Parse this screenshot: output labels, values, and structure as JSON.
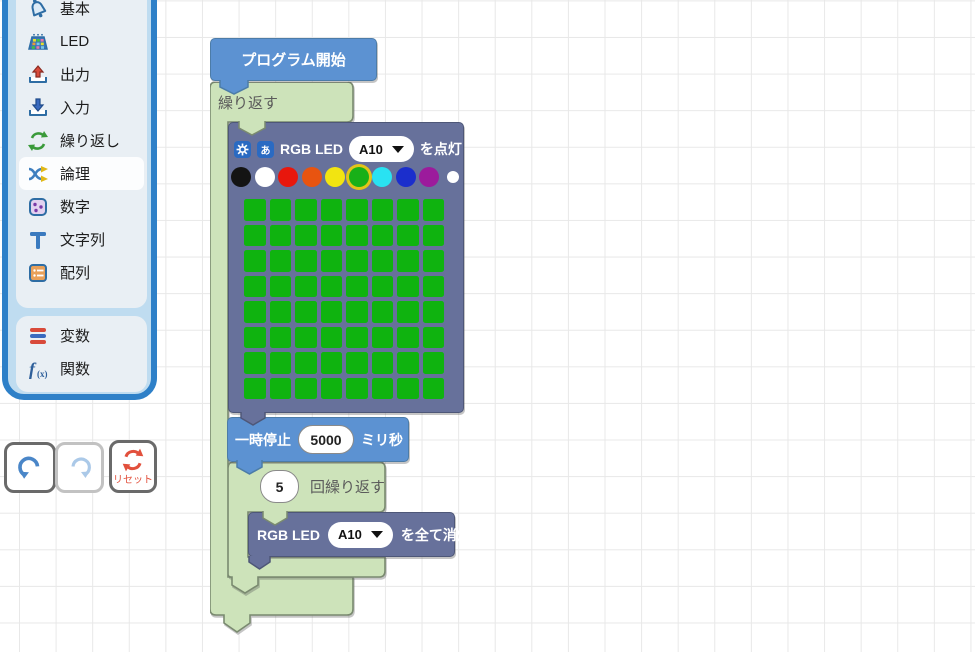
{
  "sidebar": {
    "categories": [
      {
        "label": "基本",
        "icon": "bell-icon"
      },
      {
        "label": "LED",
        "icon": "led-matrix-icon"
      },
      {
        "label": "出力",
        "icon": "output-icon"
      },
      {
        "label": "入力",
        "icon": "input-icon"
      },
      {
        "label": "繰り返し",
        "icon": "loop-icon"
      },
      {
        "label": "論理",
        "icon": "logic-icon"
      },
      {
        "label": "数字",
        "icon": "number-icon"
      },
      {
        "label": "文字列",
        "icon": "string-icon"
      },
      {
        "label": "配列",
        "icon": "array-icon"
      }
    ],
    "extra": [
      {
        "label": "変数",
        "icon": "variable-icon"
      },
      {
        "label": "関数",
        "icon": "function-icon"
      }
    ]
  },
  "controls": {
    "reset_label": "リセット"
  },
  "blocks": {
    "program_start": {
      "label": "プログラム開始"
    },
    "repeat_forever": {
      "label": "繰り返す"
    },
    "rgb_led_on": {
      "title": "RGB LED",
      "port": "A10",
      "action": "を点灯",
      "palette": [
        "#141414",
        "#ffffff",
        "#e8170d",
        "#e85410",
        "#f2e411",
        "#18b018",
        "#29e2f2",
        "#1b2ecc",
        "#9c1b9c",
        "rainbow"
      ],
      "selected_index": 5,
      "grid": {
        "rows": 8,
        "cols": 8,
        "on_color": "#0fb30f"
      }
    },
    "pause": {
      "label": "一時停止",
      "value": "5000",
      "unit": "ミリ秒"
    },
    "repeat_n": {
      "count": "5",
      "label": "回繰り返す"
    },
    "rgb_led_off": {
      "title": "RGB LED",
      "port": "A10",
      "action": "を全て消灯"
    }
  },
  "colors": {
    "accent_blue": "#2e80c8",
    "block_blue": "#5c92d2",
    "block_green": "#cde3ba",
    "block_slate": "#67719b",
    "led_green": "#0fb30f",
    "reset_red": "#e2503c",
    "selected_ring": "#e3c419"
  }
}
